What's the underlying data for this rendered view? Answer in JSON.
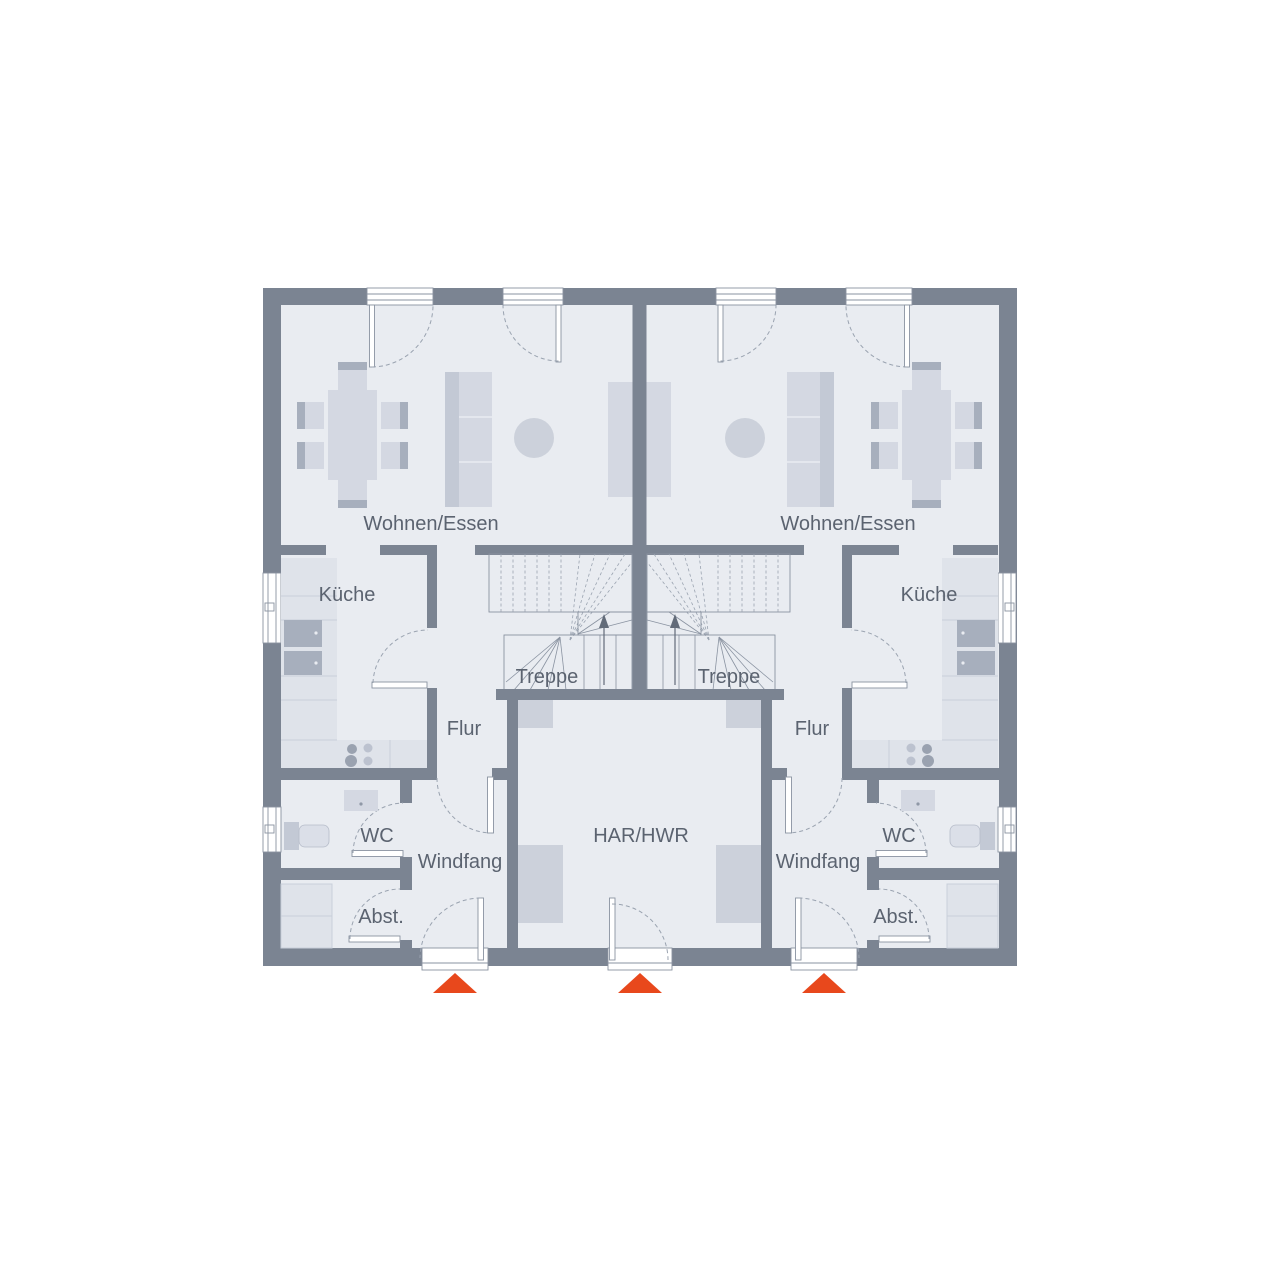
{
  "floorplan": {
    "type": "duplex-ground-floor-plan",
    "colors": {
      "wall": "#7b8492",
      "floor": "#e9ecf1",
      "furn": "#d4d8e2",
      "furndark": "#a7afbd",
      "furnmid": "#c3c9d5",
      "counter": "#dfe3ea",
      "counterline": "#c9cfda",
      "line": "#8a93a1",
      "arc": "#9aa3b0",
      "accent": "#e8481c",
      "text": "#5b6370"
    },
    "units": [
      {
        "side": "left",
        "rooms": [
          {
            "label": "Wohnen/Essen"
          },
          {
            "label": "Küche"
          },
          {
            "label": "Treppe"
          },
          {
            "label": "Flur"
          },
          {
            "label": "WC"
          },
          {
            "label": "Windfang"
          },
          {
            "label": "Abst."
          }
        ]
      },
      {
        "side": "right",
        "rooms": [
          {
            "label": "Wohnen/Essen"
          },
          {
            "label": "Küche"
          },
          {
            "label": "Treppe"
          },
          {
            "label": "Flur"
          },
          {
            "label": "WC"
          },
          {
            "label": "Windfang"
          },
          {
            "label": "Abst."
          }
        ]
      }
    ],
    "shared_rooms": [
      {
        "label": "HAR/HWR"
      }
    ],
    "entrances": {
      "count": 3,
      "marker": "orange-entrance-triangle"
    },
    "stairs": {
      "count": 2,
      "direction": "up"
    }
  }
}
